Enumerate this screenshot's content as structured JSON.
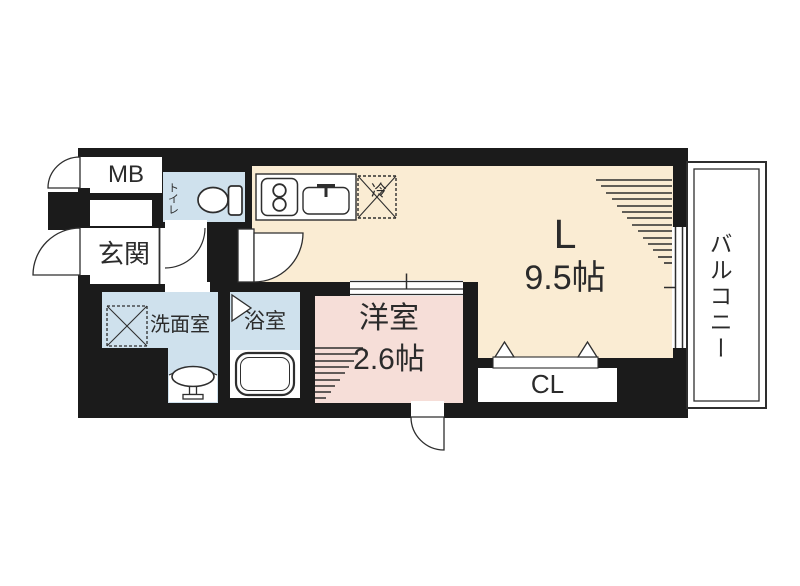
{
  "title": "apartment-floor-plan",
  "colors": {
    "wall": "#1b1b1b",
    "living": "#faecd3",
    "western_room": "#f6ded8",
    "wet_area": "#cfe1ed",
    "outline": "#2e2e2e",
    "label": "#2b2b2b"
  },
  "rooms": {
    "meter_box": {
      "label": "MB"
    },
    "entrance": {
      "label": "玄関"
    },
    "toilet": {
      "label": "トイレ"
    },
    "washroom": {
      "label": "洗面室"
    },
    "bathroom": {
      "label": "浴室"
    },
    "western_room": {
      "label": "洋室",
      "size": "2.6帖"
    },
    "living": {
      "label": "L",
      "size": "9.5帖"
    },
    "closet": {
      "label": "CL"
    },
    "balcony": {
      "label": "バルコニー"
    }
  },
  "fixtures": {
    "refrigerator": {
      "label": "冷"
    }
  }
}
